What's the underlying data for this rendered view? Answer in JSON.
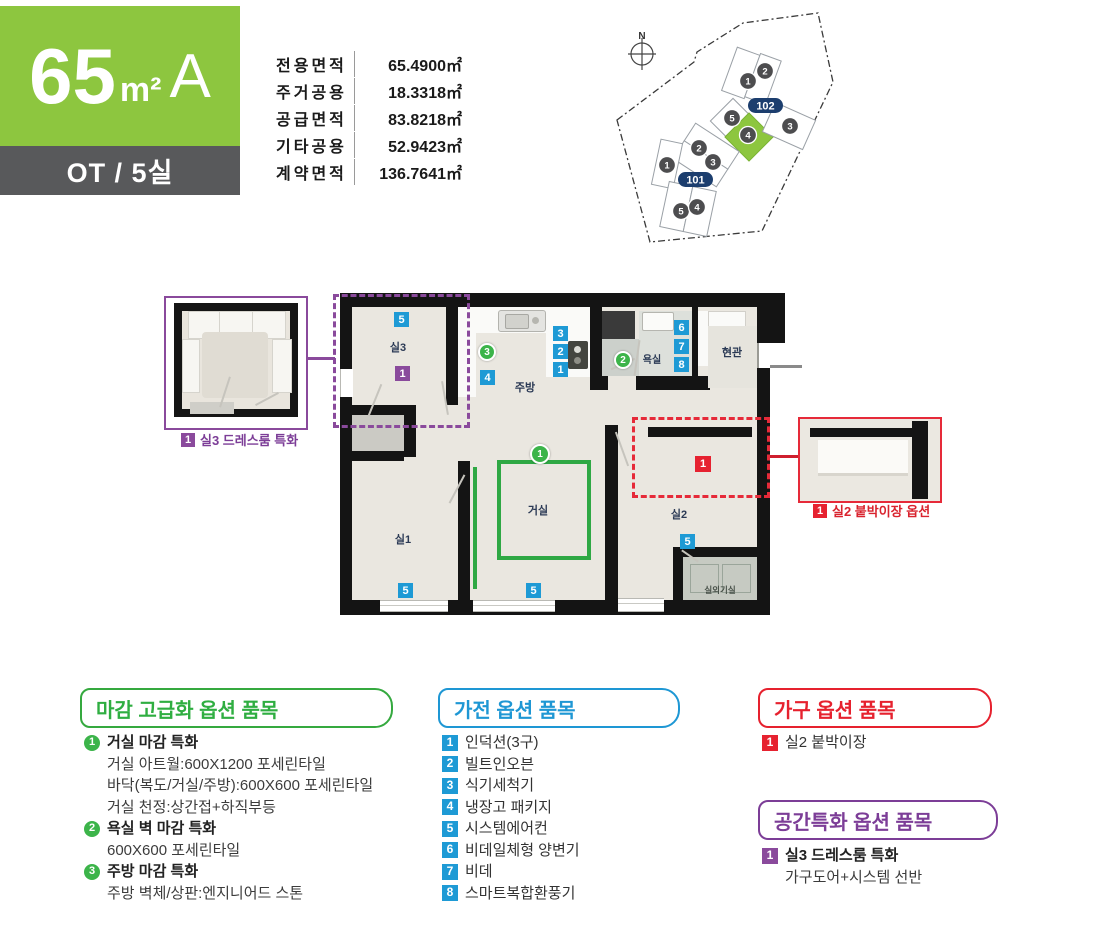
{
  "header": {
    "type_number": "65",
    "type_unit": "m²",
    "type_variant": "A",
    "subtitle": "OT / 5실",
    "area_table": [
      {
        "label": "전용면적",
        "value": "65.4900㎡"
      },
      {
        "label": "주거공용",
        "value": "18.3318㎡"
      },
      {
        "label": "공급면적",
        "value": "83.8218㎡"
      },
      {
        "label": "기타공용",
        "value": "52.9423㎡"
      },
      {
        "label": "계약면적",
        "value": "136.7641㎡"
      }
    ]
  },
  "site_plan": {
    "compass_label": "N",
    "block_labels": {
      "b102": "102",
      "b101": "101"
    },
    "units": [
      {
        "no": "1"
      },
      {
        "no": "2"
      },
      {
        "no": "5"
      },
      {
        "no": "4",
        "highlighted": true
      },
      {
        "no": "3"
      },
      {
        "no": "2"
      },
      {
        "no": "3"
      },
      {
        "no": "1"
      },
      {
        "no": "5"
      },
      {
        "no": "4"
      }
    ],
    "colors": {
      "highlight": "#8dc63f",
      "pill": "#1c3e6e",
      "unit_circle": "#4d4d4f"
    }
  },
  "floor_plan": {
    "rooms": {
      "room3": "실3",
      "kitchen": "주방",
      "bath": "욕실",
      "entry": "현관",
      "living": "거실",
      "room1": "실1",
      "room2": "실2",
      "ac_room": "실외기실"
    },
    "badges": {
      "room3_ac": "5",
      "dress": "1",
      "kitchen_finish": "3",
      "fridge_pkg": "4",
      "dishwasher": "3",
      "oven": "2",
      "induction": "1",
      "bath_finish": "2",
      "combo_toilet": "6",
      "bidet": "7",
      "vent": "8",
      "living_finish": "1",
      "living_ac": "5",
      "room1_ac": "5",
      "room2_ac": "5",
      "closet": "1"
    }
  },
  "callouts": {
    "dressroom": {
      "badge": "1",
      "label": "실3 드레스룸 특화"
    },
    "closet": {
      "badge": "1",
      "label": "실2 붙박이장 옵션"
    }
  },
  "options": {
    "finish": {
      "title": "마감 고급화 옵션 품목",
      "items": [
        {
          "no": "1",
          "name": "거실 마감 특화",
          "details": [
            "거실 아트월:600X1200 포세린타일",
            "바닥(복도/거실/주방):600X600 포세린타일",
            "거실 천정:상간접+하직부등"
          ]
        },
        {
          "no": "2",
          "name": "욕실 벽 마감 특화",
          "details": [
            "600X600 포세린타일"
          ]
        },
        {
          "no": "3",
          "name": "주방 마감 특화",
          "details": [
            "주방 벽체/상판:엔지니어드 스톤"
          ]
        }
      ]
    },
    "appliance": {
      "title": "가전 옵션 품목",
      "items": [
        {
          "no": "1",
          "label": "인덕션(3구)"
        },
        {
          "no": "2",
          "label": "빌트인오븐"
        },
        {
          "no": "3",
          "label": "식기세척기"
        },
        {
          "no": "4",
          "label": "냉장고 패키지"
        },
        {
          "no": "5",
          "label": "시스템에어컨"
        },
        {
          "no": "6",
          "label": "비데일체형 양변기"
        },
        {
          "no": "7",
          "label": "비데"
        },
        {
          "no": "8",
          "label": "스마트복합환풍기"
        }
      ]
    },
    "furniture": {
      "title": "가구 옵션 품목",
      "items": [
        {
          "no": "1",
          "label": "실2 붙박이장"
        }
      ]
    },
    "space": {
      "title": "공간특화 옵션 품목",
      "items": [
        {
          "no": "1",
          "name": "실3 드레스룸 특화",
          "details": [
            "가구도어+시스템 선반"
          ]
        }
      ]
    }
  }
}
